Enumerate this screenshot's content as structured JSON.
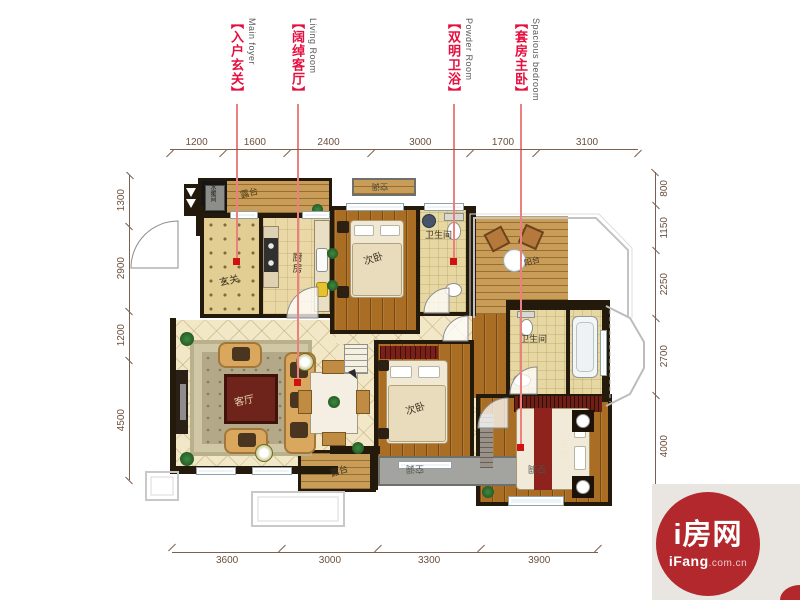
{
  "annotations": [
    {
      "zh": "【入户玄关】",
      "en": "Main foyer"
    },
    {
      "zh": "【阔绰客厅】",
      "en": "Living Room"
    },
    {
      "zh": "【双明卫浴】",
      "en": "Powder Room"
    },
    {
      "zh": "【套房主卧】",
      "en": "Spacious bedroom"
    }
  ],
  "dims": {
    "top": [
      "1200",
      "1600",
      "2400",
      "3000",
      "1700",
      "3100"
    ],
    "bottom": [
      "3600",
      "3000",
      "3300",
      "3900"
    ],
    "left": [
      "1300",
      "2900",
      "1200",
      "4500"
    ],
    "right": [
      "800",
      "1150",
      "2250",
      "2700",
      "4000"
    ]
  },
  "rooms": {
    "terrace_tl": "露台",
    "utility": "水暖间",
    "foyer": "玄关",
    "kitchen": "厨房",
    "bedroom_top": "次卧",
    "bath_top": "卫生间",
    "balcony_tr": "阳台",
    "bath_master": "卫生间",
    "living": "客厅",
    "bedroom_mid": "次卧",
    "master": "主卧",
    "terrace_bottom": "露台",
    "ac": "空调"
  },
  "logo": {
    "name": "i房网",
    "sub_bold": "iFang",
    "sub_rest": ".com.cn"
  },
  "colors": {
    "annotation_red": "#e50f3f",
    "annotation_line": "#ea8080",
    "marker_red": "#cf1212",
    "wall": "#241a0c",
    "dimension": "#7c6150",
    "logo_red": "#b2282c",
    "logo_bg": "#e9e6e2"
  }
}
